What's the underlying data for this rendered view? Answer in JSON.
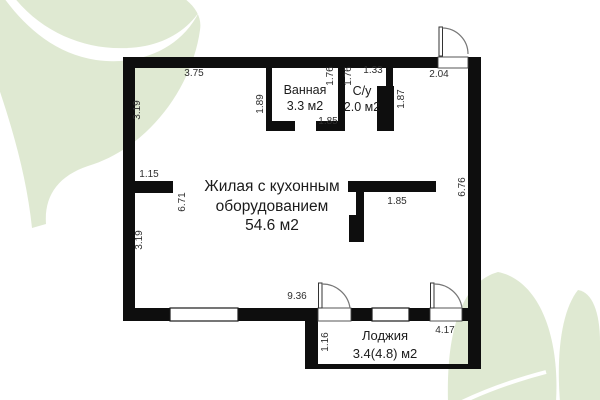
{
  "title": "floor-plan",
  "colors": {
    "wall": "#0e0e0e",
    "leaf_decor": "#dfe9d2",
    "dimension_text": "#2e2e2e",
    "room_text": "#1b1b1b",
    "background": "#ffffff"
  },
  "rooms": {
    "bathroom": {
      "name": "Ванная",
      "area": "3.3 м2"
    },
    "wc": {
      "name": "С/у",
      "area": "2.0 м2"
    },
    "living": {
      "line1": "Жилая с кухонным",
      "line2": "оборудованием",
      "area": "54.6 м2"
    },
    "loggia": {
      "name": "Лоджия",
      "area": "3.4(4.8) м2"
    }
  },
  "dimensions": {
    "top_span": "3.75",
    "left_upper": "3.19",
    "bath_left": "1.89",
    "bath_right": "1.76",
    "wc_left": "1.76",
    "wc_top": "1.33",
    "wc_right": "1.87",
    "entry_top": "2.04",
    "bath_bottom": "1.85",
    "stub_top": "1.15",
    "stub_right": "6.71",
    "left_lower": "3.19",
    "kitchen_bottom": "1.85",
    "right_span": "6.76",
    "bottom_span": "9.36",
    "loggia_top": "4.17",
    "loggia_left": "1.16"
  },
  "icons": {
    "door_swing": "quarter-arc",
    "window": "white-band",
    "leaf": "pale-green-leaf"
  }
}
